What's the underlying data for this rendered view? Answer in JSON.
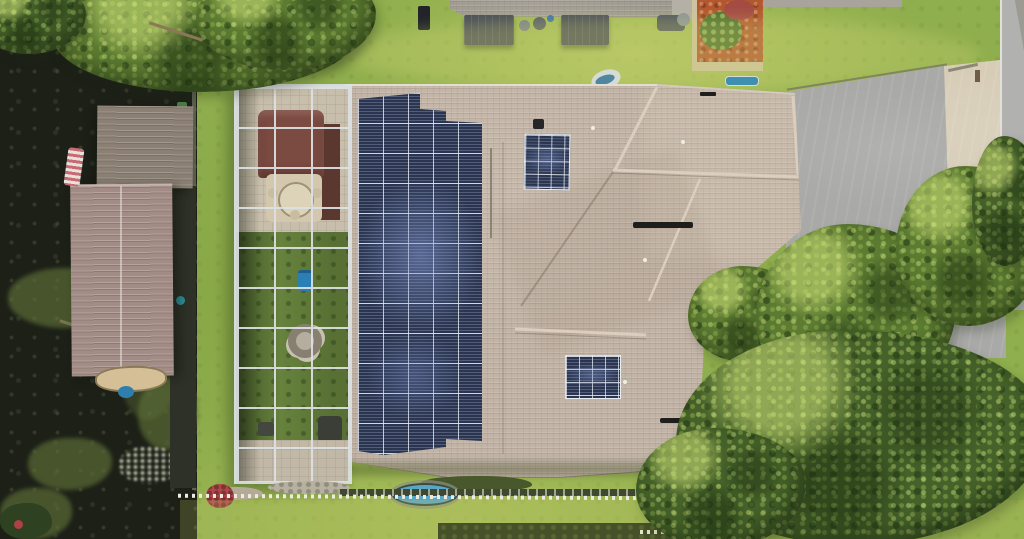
{
  "scene": {
    "type": "aerial-drone-photo",
    "description": "Overhead aerial view of a waterfront home with a large rooftop solar array, screened pool enclosure with gazebo, boathouse and dock on dark canal water, lawns, neighboring house, concrete driveway, street and large tree canopies."
  },
  "objects": {
    "water": "Dark canal / lake water with floating vegetation",
    "seawall": "Seawall edge along the water",
    "dock": "Dock walkway beside the boathouse",
    "boathouse_upper": "Boathouse upper metal roof section",
    "boathouse_lower": "Boathouse lower metal roof section",
    "american_flag": "Flag hanging at the dock",
    "rowboat": "Small boat moored at the boathouse",
    "tree_top_left": "Tree canopy overhanging the water",
    "screen_enclosure": "Screened pool enclosure (lanai cage)",
    "gazebo": "Gazebo with dark red canopy",
    "patio_table": "Round patio table with chairs",
    "fire_pit": "Fire pit with seating inside the lanai",
    "pool_pump": "Blue equipment item inside the lanai",
    "house_roof": "Main house shingle roof",
    "solar_array_main": "Large rooftop solar panel array",
    "solar_array_small_top": "Small solar panel group near front ridge",
    "solar_array_small_rear": "Small solar panel group on rear roof plane",
    "roof_vent": "Dark roof ridge vent",
    "neighbor_roof": "Neighboring house roof at top",
    "awning": "Dark patio awning of neighboring house",
    "garden_bed": "Red mulch garden bed with shrub",
    "driveway": "Concrete driveway",
    "driveway_apron": "Light concrete driveway apron",
    "street": "Street pavement with curb",
    "mailbox": "Mailbox post by the street",
    "trees_right": "Large oak tree canopy on the right",
    "white_fence": "White picket fence line",
    "garden_pond": "Small blue garden pond",
    "flower_bush": "Red flowering bush",
    "hedge": "Dark hedge row at bottom",
    "spa_cover": "White and blue covered item near roof edge",
    "kiddie_pool": "Small blue pool on the lawn",
    "lawn": "Grass lawn"
  },
  "colors": {
    "grass": "#8fae4d",
    "grass_light": "#c9cf7a",
    "tree": "#5d7c32",
    "tree_dark": "#46622a",
    "water": "#1c2017",
    "water_plants": "#5f7038",
    "roof": "#c2b4a6",
    "roof_ridge": "#dbcebf",
    "panel": "#2b3550",
    "panel_sheen": "#7d91c8",
    "panel_grid": "#e8eef4",
    "boathouse_upper": "#8b8073",
    "boathouse_lower": "#a38c86",
    "dock": "#2e3127",
    "boat": "#d4bf97",
    "frame": "#dde2e4",
    "deck": "#c8beac",
    "gazebo": "#7b4a41",
    "lanai_lawn": "#67823d",
    "neighbor_roof": "#9c988f",
    "awning": "#4c5158",
    "mulch": "#b2572e",
    "shrub": "#4e7030",
    "driveway": "#a9a9a7",
    "apron": "#d7cdb7",
    "street": "#b1b1af",
    "curb": "#e0dfd8",
    "fence": "#efecdf",
    "pond": "#59a7c6",
    "flowers": "#b2474b",
    "hedge": "#243119",
    "blue_item": "#3e8fb0",
    "pump_blue": "#2b7fb4",
    "flag_red": "#c86a74"
  }
}
